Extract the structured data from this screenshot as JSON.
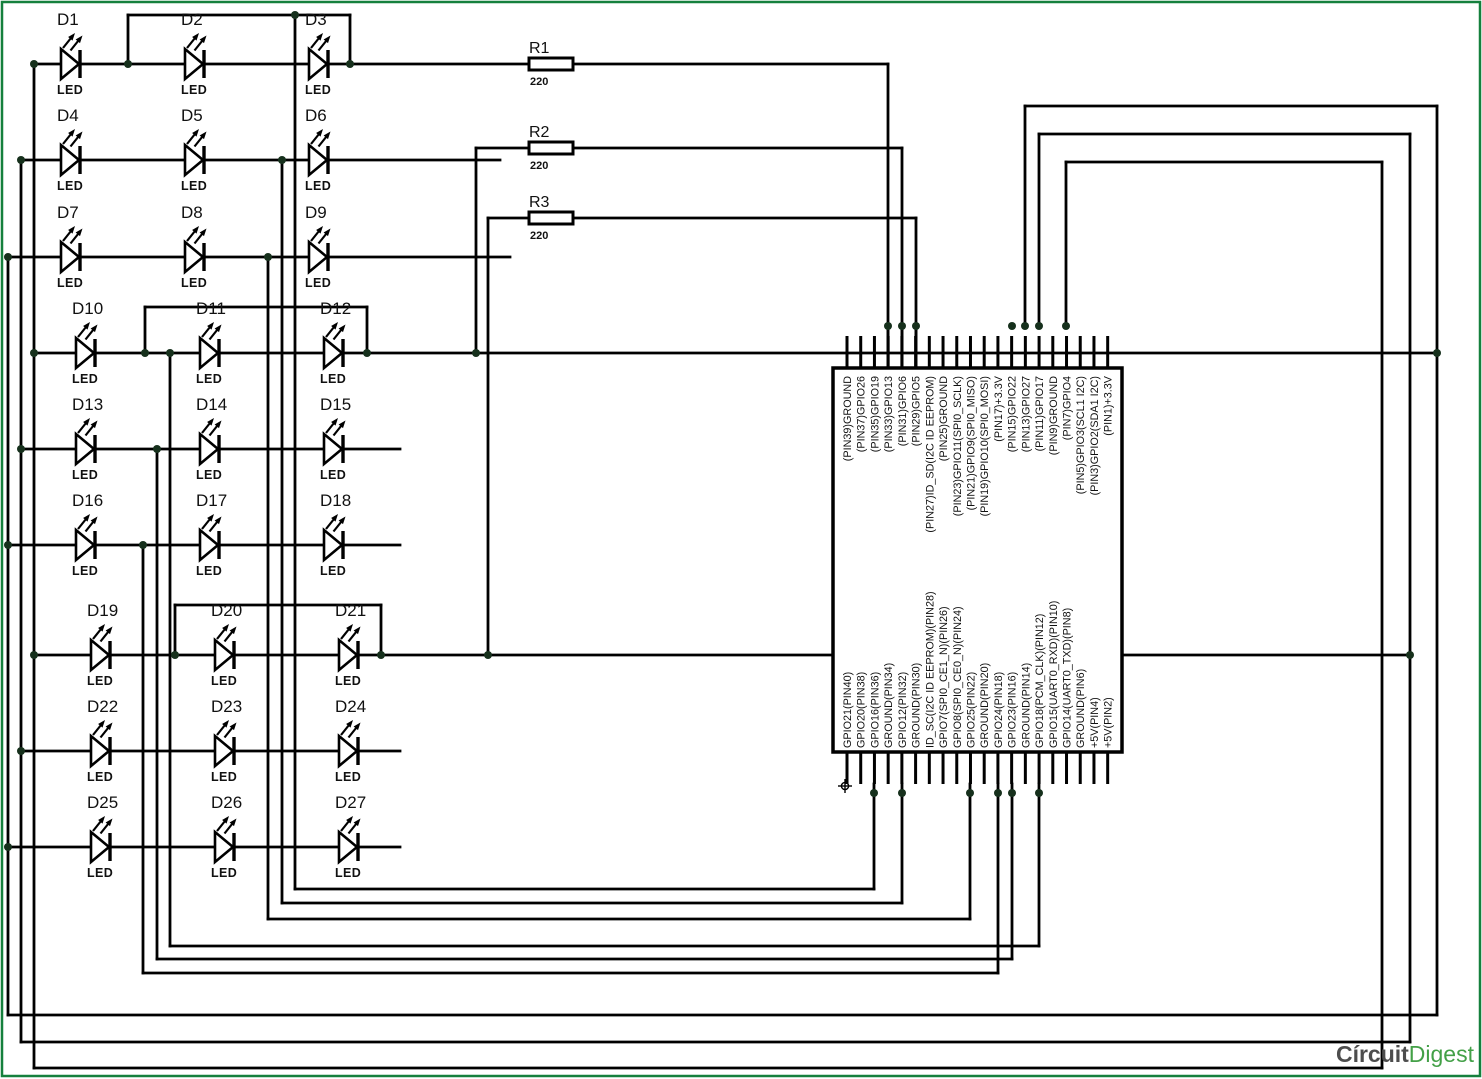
{
  "schematic": {
    "title": "LED cube wiring to Raspberry Pi GPIO header",
    "led_type_label": "LED",
    "leds": [
      {
        "id": "D1"
      },
      {
        "id": "D2"
      },
      {
        "id": "D3"
      },
      {
        "id": "D4"
      },
      {
        "id": "D5"
      },
      {
        "id": "D6"
      },
      {
        "id": "D7"
      },
      {
        "id": "D8"
      },
      {
        "id": "D9"
      },
      {
        "id": "D10"
      },
      {
        "id": "D11"
      },
      {
        "id": "D12"
      },
      {
        "id": "D13"
      },
      {
        "id": "D14"
      },
      {
        "id": "D15"
      },
      {
        "id": "D16"
      },
      {
        "id": "D17"
      },
      {
        "id": "D18"
      },
      {
        "id": "D19"
      },
      {
        "id": "D20"
      },
      {
        "id": "D21"
      },
      {
        "id": "D22"
      },
      {
        "id": "D23"
      },
      {
        "id": "D24"
      },
      {
        "id": "D25"
      },
      {
        "id": "D26"
      },
      {
        "id": "D27"
      }
    ],
    "resistors": [
      {
        "name": "R1",
        "value": "220"
      },
      {
        "name": "R2",
        "value": "220"
      },
      {
        "name": "R3",
        "value": "220"
      }
    ],
    "raspberry_pi_header": {
      "top_pins": [
        "(PIN39)GROUND",
        "(PIN37)GPIO26",
        "(PIN35)GPIO19",
        "(PIN33)GPIO13",
        "(PIN31)GPIO6",
        "(PIN29)GPIO5",
        "(PIN27)ID_SD(I2C ID EEPROM)",
        "(PIN25)GROUND",
        "(PIN23)GPIO11(SPI0_SCLK)",
        "(PIN21)GPIO9(SPI0_MISO)",
        "(PIN19)GPIO10(SPI0_MOSI)",
        "(PIN17)+3.3V",
        "(PIN15)GPIO22",
        "(PIN13)GPIO27",
        "(PIN11)GPIO17",
        "(PIN9)GROUND",
        "(PIN7)GPIO4",
        "(PIN5)GPIO3(SCL1 I2C)",
        "(PIN3)GPIO2(SDA1 I2C)",
        "(PIN1)+3.3V"
      ],
      "bottom_pins": [
        "GPIO21(PIN40)",
        "GPIO20(PIN38)",
        "GPIO16(PIN36)",
        "GROUND(PIN34)",
        "GPIO12(PIN32)",
        "GROUND(PIN30)",
        "ID_SC(I2C ID EEPROM)(PIN28)",
        "GPIO7(SPI0_CE1_N)(PIN26)",
        "GPIO8(SPI0_CE0_N)(PIN24)",
        "GPIO25(PIN22)",
        "GROUND(PIN20)",
        "GPIO24(PIN18)",
        "GPIO23(PIN16)",
        "GROUND(PIN14)",
        "GPIO18(PCM_CLK)(PIN12)",
        "GPIO15(UART0_RXD)(PIN10)",
        "GPIO14(UART0_TXD)(PIN8)",
        "GROUND(PIN6)",
        "+5V(PIN4)",
        "+5V(PIN2)"
      ]
    },
    "watermark": {
      "circuit": "Círcuit",
      "digest": "Digest"
    },
    "colors": {
      "wire": "#000000",
      "junction": "#16301c",
      "border_green": "#15803d",
      "logo_gray": "#4d4d4d",
      "logo_green": "#43a047"
    }
  }
}
